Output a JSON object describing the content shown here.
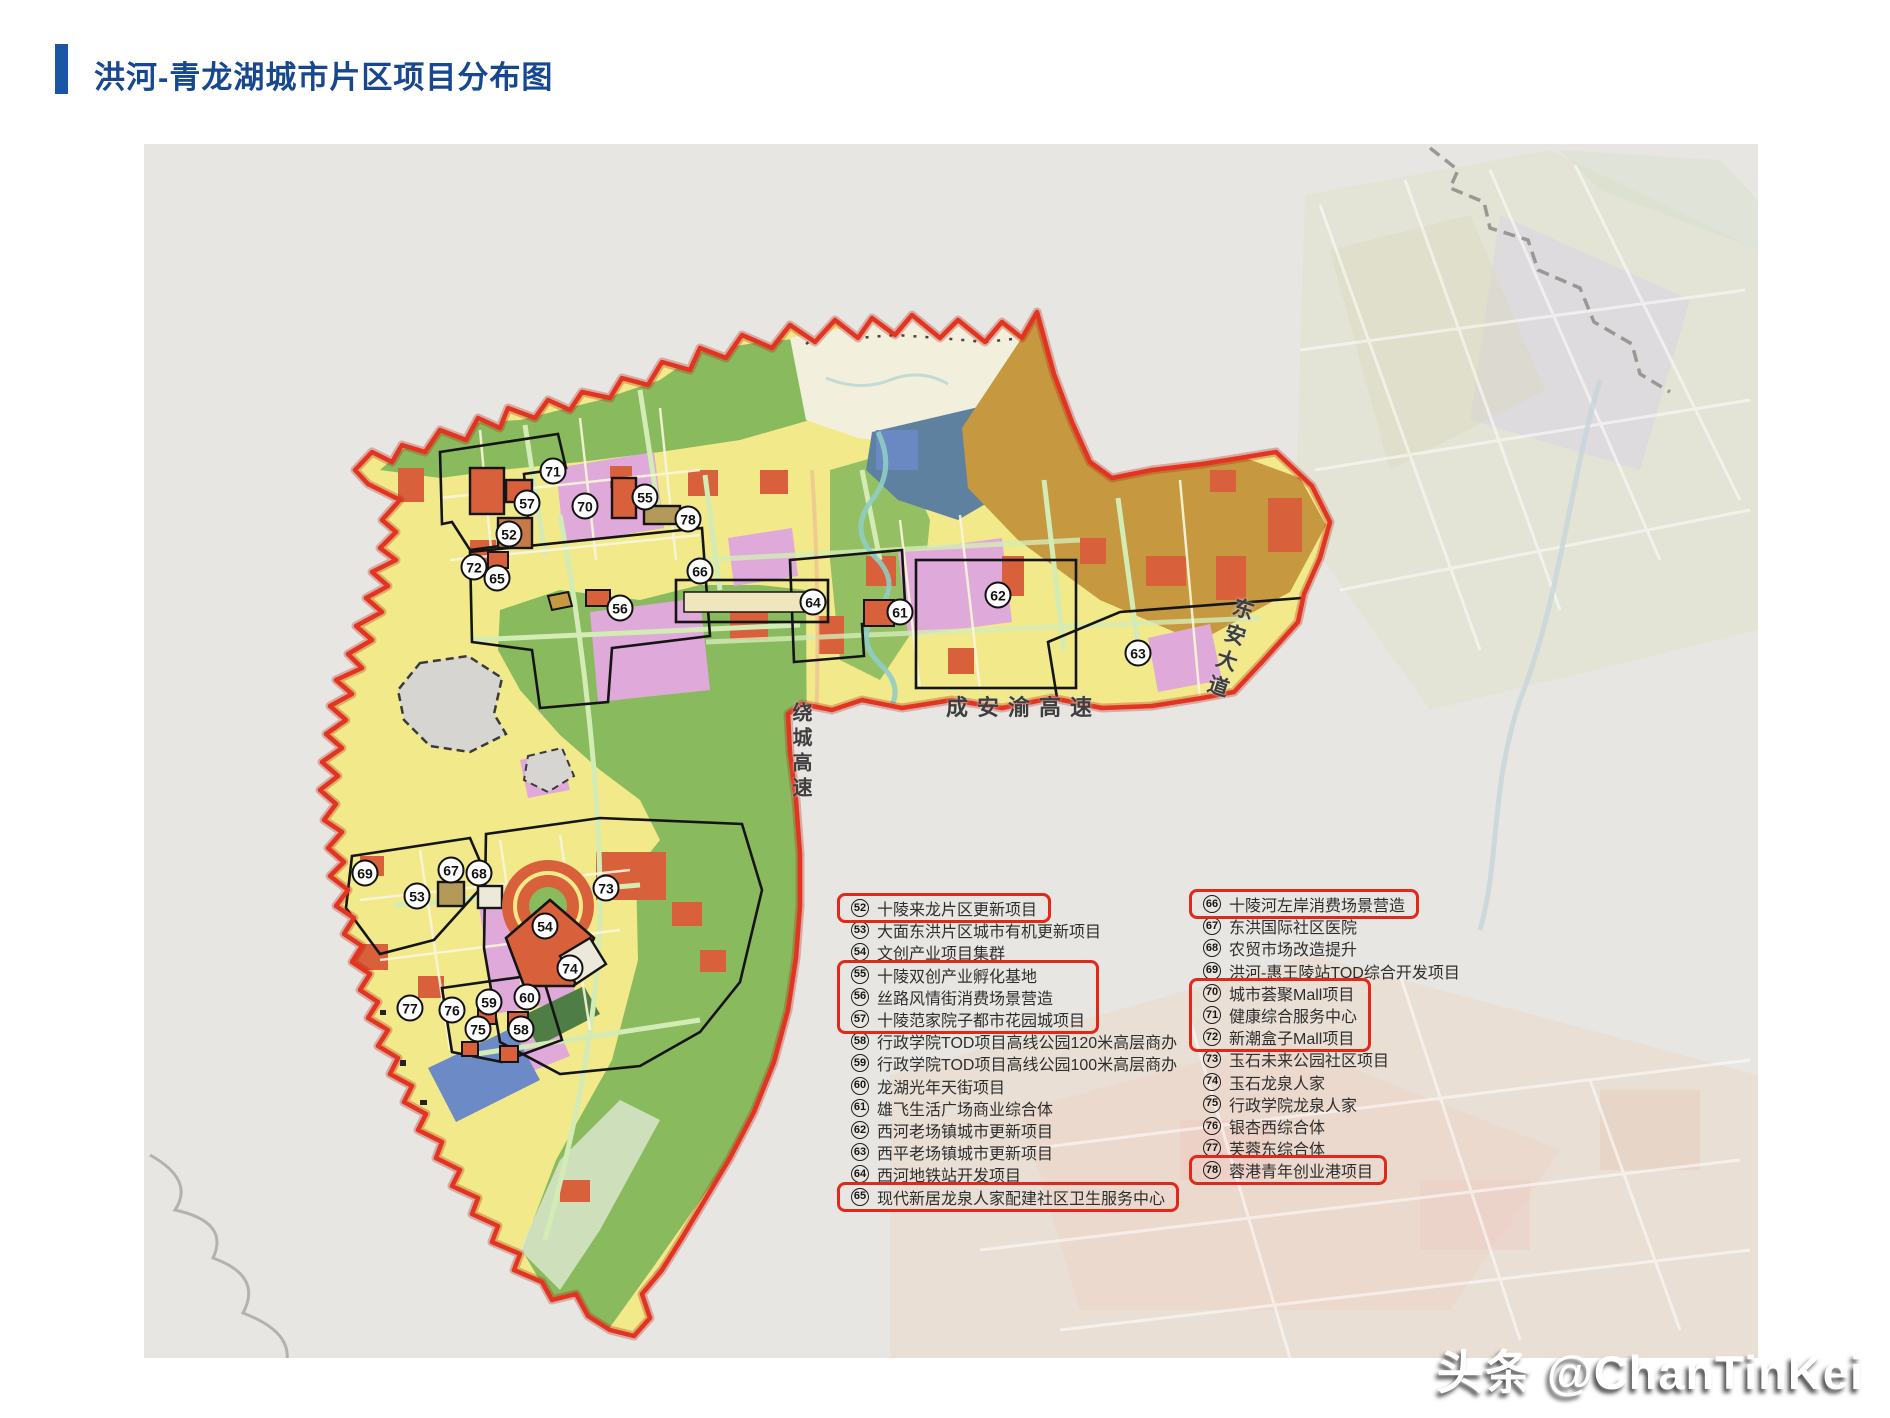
{
  "title": "洪河-青龙湖城市片区项目分布图",
  "watermark": "头条 @ChanTinKei",
  "colors": {
    "title_blue": "#17478f",
    "accent_bar_blue": "#1c55a5",
    "boundary_red": "#e23420",
    "highlight_red": "#e2281b",
    "map_background": "#e8e6e2",
    "urban_yellow": "#f1e98a",
    "park_green": "#8aba5e",
    "pink_zone": "#dfa9d9",
    "red_patch": "#d8603a",
    "ochre_zone": "#c6983f",
    "blue_gray_zone": "#5f81a0"
  },
  "map": {
    "road_labels": [
      {
        "id": "raocheng",
        "text": "绕城高速",
        "orientation": "vertical"
      },
      {
        "id": "chenganyu",
        "text": "成安渝高速",
        "orientation": "horizontal"
      },
      {
        "id": "dongan",
        "text": "东安大道",
        "orientation": "diagonal"
      }
    ],
    "markers": [
      {
        "num": "52",
        "x": 509,
        "y": 534
      },
      {
        "num": "53",
        "x": 417,
        "y": 896
      },
      {
        "num": "54",
        "x": 545,
        "y": 926
      },
      {
        "num": "55",
        "x": 645,
        "y": 497
      },
      {
        "num": "56",
        "x": 620,
        "y": 608
      },
      {
        "num": "57",
        "x": 527,
        "y": 503
      },
      {
        "num": "58",
        "x": 521,
        "y": 1029
      },
      {
        "num": "59",
        "x": 489,
        "y": 1002
      },
      {
        "num": "60",
        "x": 527,
        "y": 997
      },
      {
        "num": "61",
        "x": 900,
        "y": 612
      },
      {
        "num": "62",
        "x": 998,
        "y": 595
      },
      {
        "num": "63",
        "x": 1138,
        "y": 653
      },
      {
        "num": "64",
        "x": 813,
        "y": 602
      },
      {
        "num": "65",
        "x": 497,
        "y": 578
      },
      {
        "num": "66",
        "x": 700,
        "y": 571
      },
      {
        "num": "67",
        "x": 451,
        "y": 870
      },
      {
        "num": "68",
        "x": 479,
        "y": 873
      },
      {
        "num": "69",
        "x": 365,
        "y": 873
      },
      {
        "num": "70",
        "x": 585,
        "y": 506
      },
      {
        "num": "71",
        "x": 553,
        "y": 471
      },
      {
        "num": "72",
        "x": 474,
        "y": 567
      },
      {
        "num": "73",
        "x": 606,
        "y": 888
      },
      {
        "num": "74",
        "x": 570,
        "y": 968
      },
      {
        "num": "75",
        "x": 478,
        "y": 1029
      },
      {
        "num": "76",
        "x": 452,
        "y": 1010
      },
      {
        "num": "77",
        "x": 410,
        "y": 1008
      },
      {
        "num": "78",
        "x": 688,
        "y": 519
      }
    ]
  },
  "legend": {
    "left_column": [
      {
        "num": "52",
        "label": "十陵来龙片区更新项目",
        "highlighted": true
      },
      {
        "num": "53",
        "label": "大面东洪片区城市有机更新项目",
        "highlighted": false
      },
      {
        "num": "54",
        "label": "文创产业项目集群",
        "highlighted": false
      },
      {
        "num": "55",
        "label": "十陵双创产业孵化基地",
        "highlighted": true
      },
      {
        "num": "56",
        "label": "丝路风情街消费场景营造",
        "highlighted": true
      },
      {
        "num": "57",
        "label": "十陵范家院子都市花园城项目",
        "highlighted": true
      },
      {
        "num": "58",
        "label": "行政学院TOD项目高线公园120米高层商办",
        "highlighted": false
      },
      {
        "num": "59",
        "label": "行政学院TOD项目高线公园100米高层商办",
        "highlighted": false
      },
      {
        "num": "60",
        "label": "龙湖光年天街项目",
        "highlighted": false
      },
      {
        "num": "61",
        "label": "雄飞生活广场商业综合体",
        "highlighted": false
      },
      {
        "num": "62",
        "label": "西河老场镇城市更新项目",
        "highlighted": false
      },
      {
        "num": "63",
        "label": "西平老场镇城市更新项目",
        "highlighted": false
      },
      {
        "num": "64",
        "label": "西河地铁站开发项目",
        "highlighted": false
      },
      {
        "num": "65",
        "label": "现代新居龙泉人家配建社区卫生服务中心",
        "highlighted": true
      }
    ],
    "right_column": [
      {
        "num": "66",
        "label": "十陵河左岸消费场景营造",
        "highlighted": true
      },
      {
        "num": "67",
        "label": "东洪国际社区医院",
        "highlighted": false
      },
      {
        "num": "68",
        "label": "农贸市场改造提升",
        "highlighted": false
      },
      {
        "num": "69",
        "label": "洪河-惠王陵站TOD综合开发项目",
        "highlighted": false
      },
      {
        "num": "70",
        "label": "城市荟聚Mall项目",
        "highlighted": true
      },
      {
        "num": "71",
        "label": "健康综合服务中心",
        "highlighted": true
      },
      {
        "num": "72",
        "label": "新潮盒子Mall项目",
        "highlighted": true
      },
      {
        "num": "73",
        "label": "玉石未来公园社区项目",
        "highlighted": false
      },
      {
        "num": "74",
        "label": "玉石龙泉人家",
        "highlighted": false
      },
      {
        "num": "75",
        "label": "行政学院龙泉人家",
        "highlighted": false
      },
      {
        "num": "76",
        "label": "银杏西综合体",
        "highlighted": false
      },
      {
        "num": "77",
        "label": "芙蓉东综合体",
        "highlighted": false
      },
      {
        "num": "78",
        "label": "蓉港青年创业港项目",
        "highlighted": true
      }
    ]
  }
}
